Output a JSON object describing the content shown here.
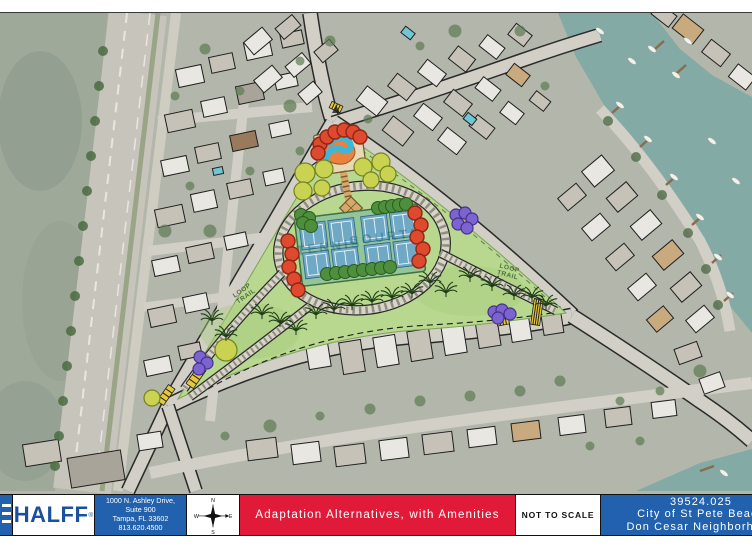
{
  "title_block": {
    "firm_name": "HALFF",
    "registered_mark": "®",
    "address_lines": [
      "1000 N. Ashley Drive,",
      "Suite 900",
      "Tampa, FL 33602",
      "813.620.4500"
    ],
    "compass": {
      "north": "N",
      "south": "S",
      "east": "E",
      "west": "W"
    },
    "sheet_title": "Adaptation Alternatives, with Amenities",
    "scale_note": "NOT TO SCALE",
    "project_number": "39524.025",
    "client_line": "City of St Pete Beach",
    "project_line": "Don Cesar Neighborhood"
  },
  "map_labels": {
    "loop_word": "LOOP",
    "trail_word": "TRAIL",
    "tennis_word": "TENNIS",
    "courts_word": "COURTS"
  },
  "colors": {
    "halff_blue": "#1b4f9f",
    "panel_blue": "#2161ad",
    "title_red": "#e01a38",
    "park_green": "#b7d88e",
    "court_blue": "#6fa9c6",
    "court_pad_green": "#93c59a",
    "water_teal": "#84aaa6",
    "crayon_red": "#df4a2e",
    "crayon_yellow_green": "#c9d351",
    "crayon_purple": "#7b64d2",
    "boardwalk_tan": "#d8a868",
    "hatch_yellow": "#e5c83c"
  }
}
